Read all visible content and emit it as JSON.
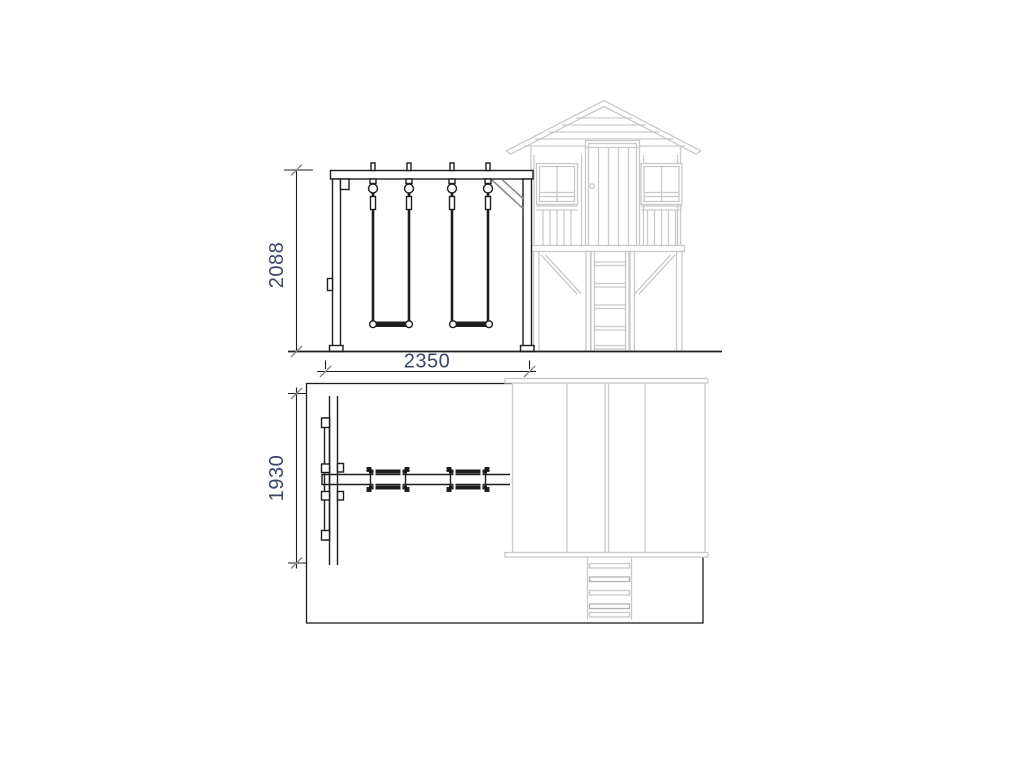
{
  "drawing": {
    "colors": {
      "line": "#1d1d1d",
      "house": "#c9c9c9",
      "house_dark": "#b0b0b0",
      "brace": "#8c8c8c",
      "dim": "#3b4766",
      "background": "#ffffff"
    },
    "views": {
      "front_elevation": {
        "height_dim": "2088",
        "width_dim": "2350"
      },
      "plan": {
        "depth_dim": "1930"
      }
    }
  }
}
